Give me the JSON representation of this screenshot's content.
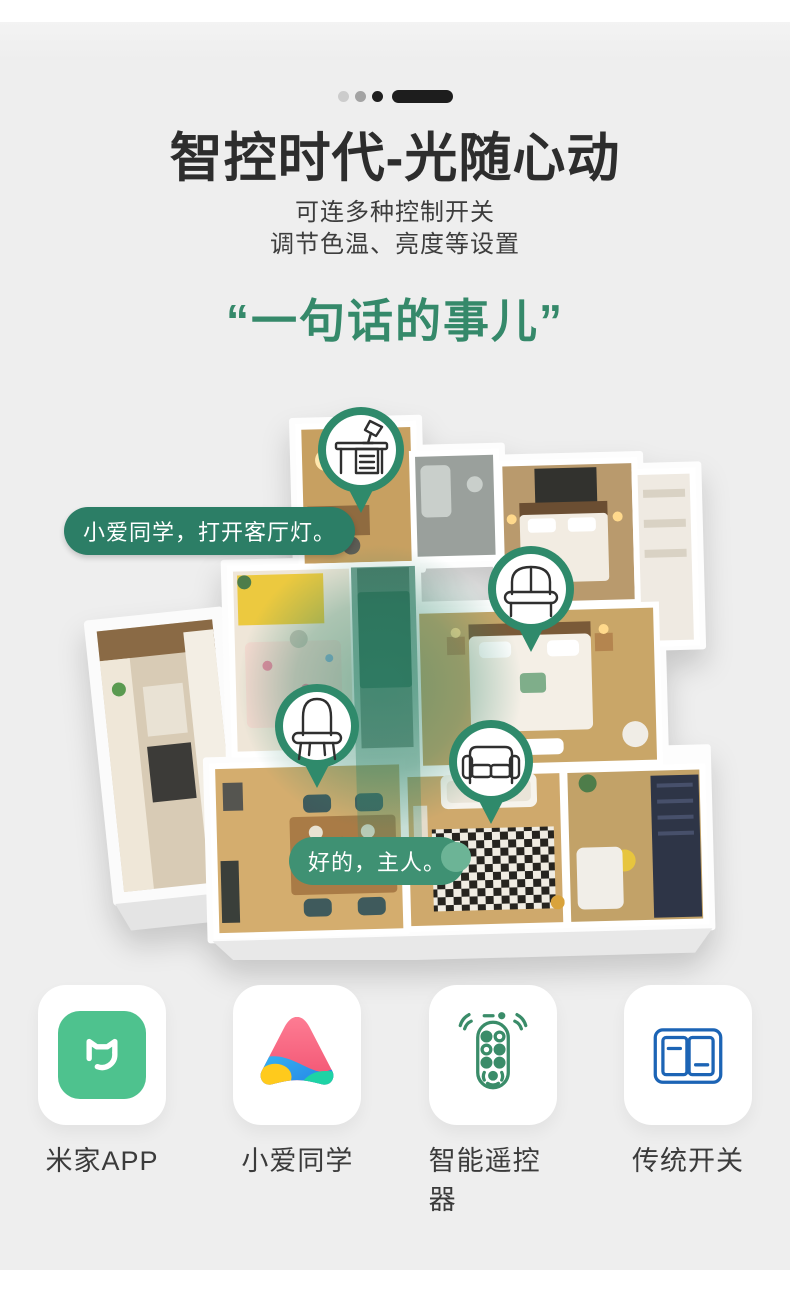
{
  "hero": {
    "title": "智控时代-光随心动",
    "subtitle_line1": "可连多种控制开关",
    "subtitle_line2": "调节色温、亮度等设置",
    "quote": "“一句话的事儿”"
  },
  "scene": {
    "voice_command": "小爱同学，打开客厅灯。",
    "voice_reply": "好的，主人。",
    "pins": [
      {
        "icon": "desk-lamp-pin-icon",
        "room": "study"
      },
      {
        "icon": "bed-pin-icon",
        "room": "bedroom"
      },
      {
        "icon": "dressing-table-pin-icon",
        "room": "kids-room"
      },
      {
        "icon": "sofa-pin-icon",
        "room": "living-room"
      }
    ]
  },
  "features": [
    {
      "label": "米家APP",
      "icon": "mijia-app-icon"
    },
    {
      "label": "小爱同学",
      "icon": "xiaoai-assistant-icon"
    },
    {
      "label": "智能遥控器",
      "icon": "smart-remote-icon"
    },
    {
      "label": "传统开关",
      "icon": "wall-switch-icon"
    }
  ],
  "colors": {
    "background": "#EFEFEF",
    "title_dark": "#2D2D2D",
    "quote_green": "#35896A",
    "pin_green": "#2F8A6B",
    "bubble_dark_green": "#2C7E66",
    "bubble_light_green": "#3F9173",
    "mijia_green": "#4EC28E",
    "remote_green": "#3A8C69",
    "switch_blue": "#1C64B5"
  }
}
